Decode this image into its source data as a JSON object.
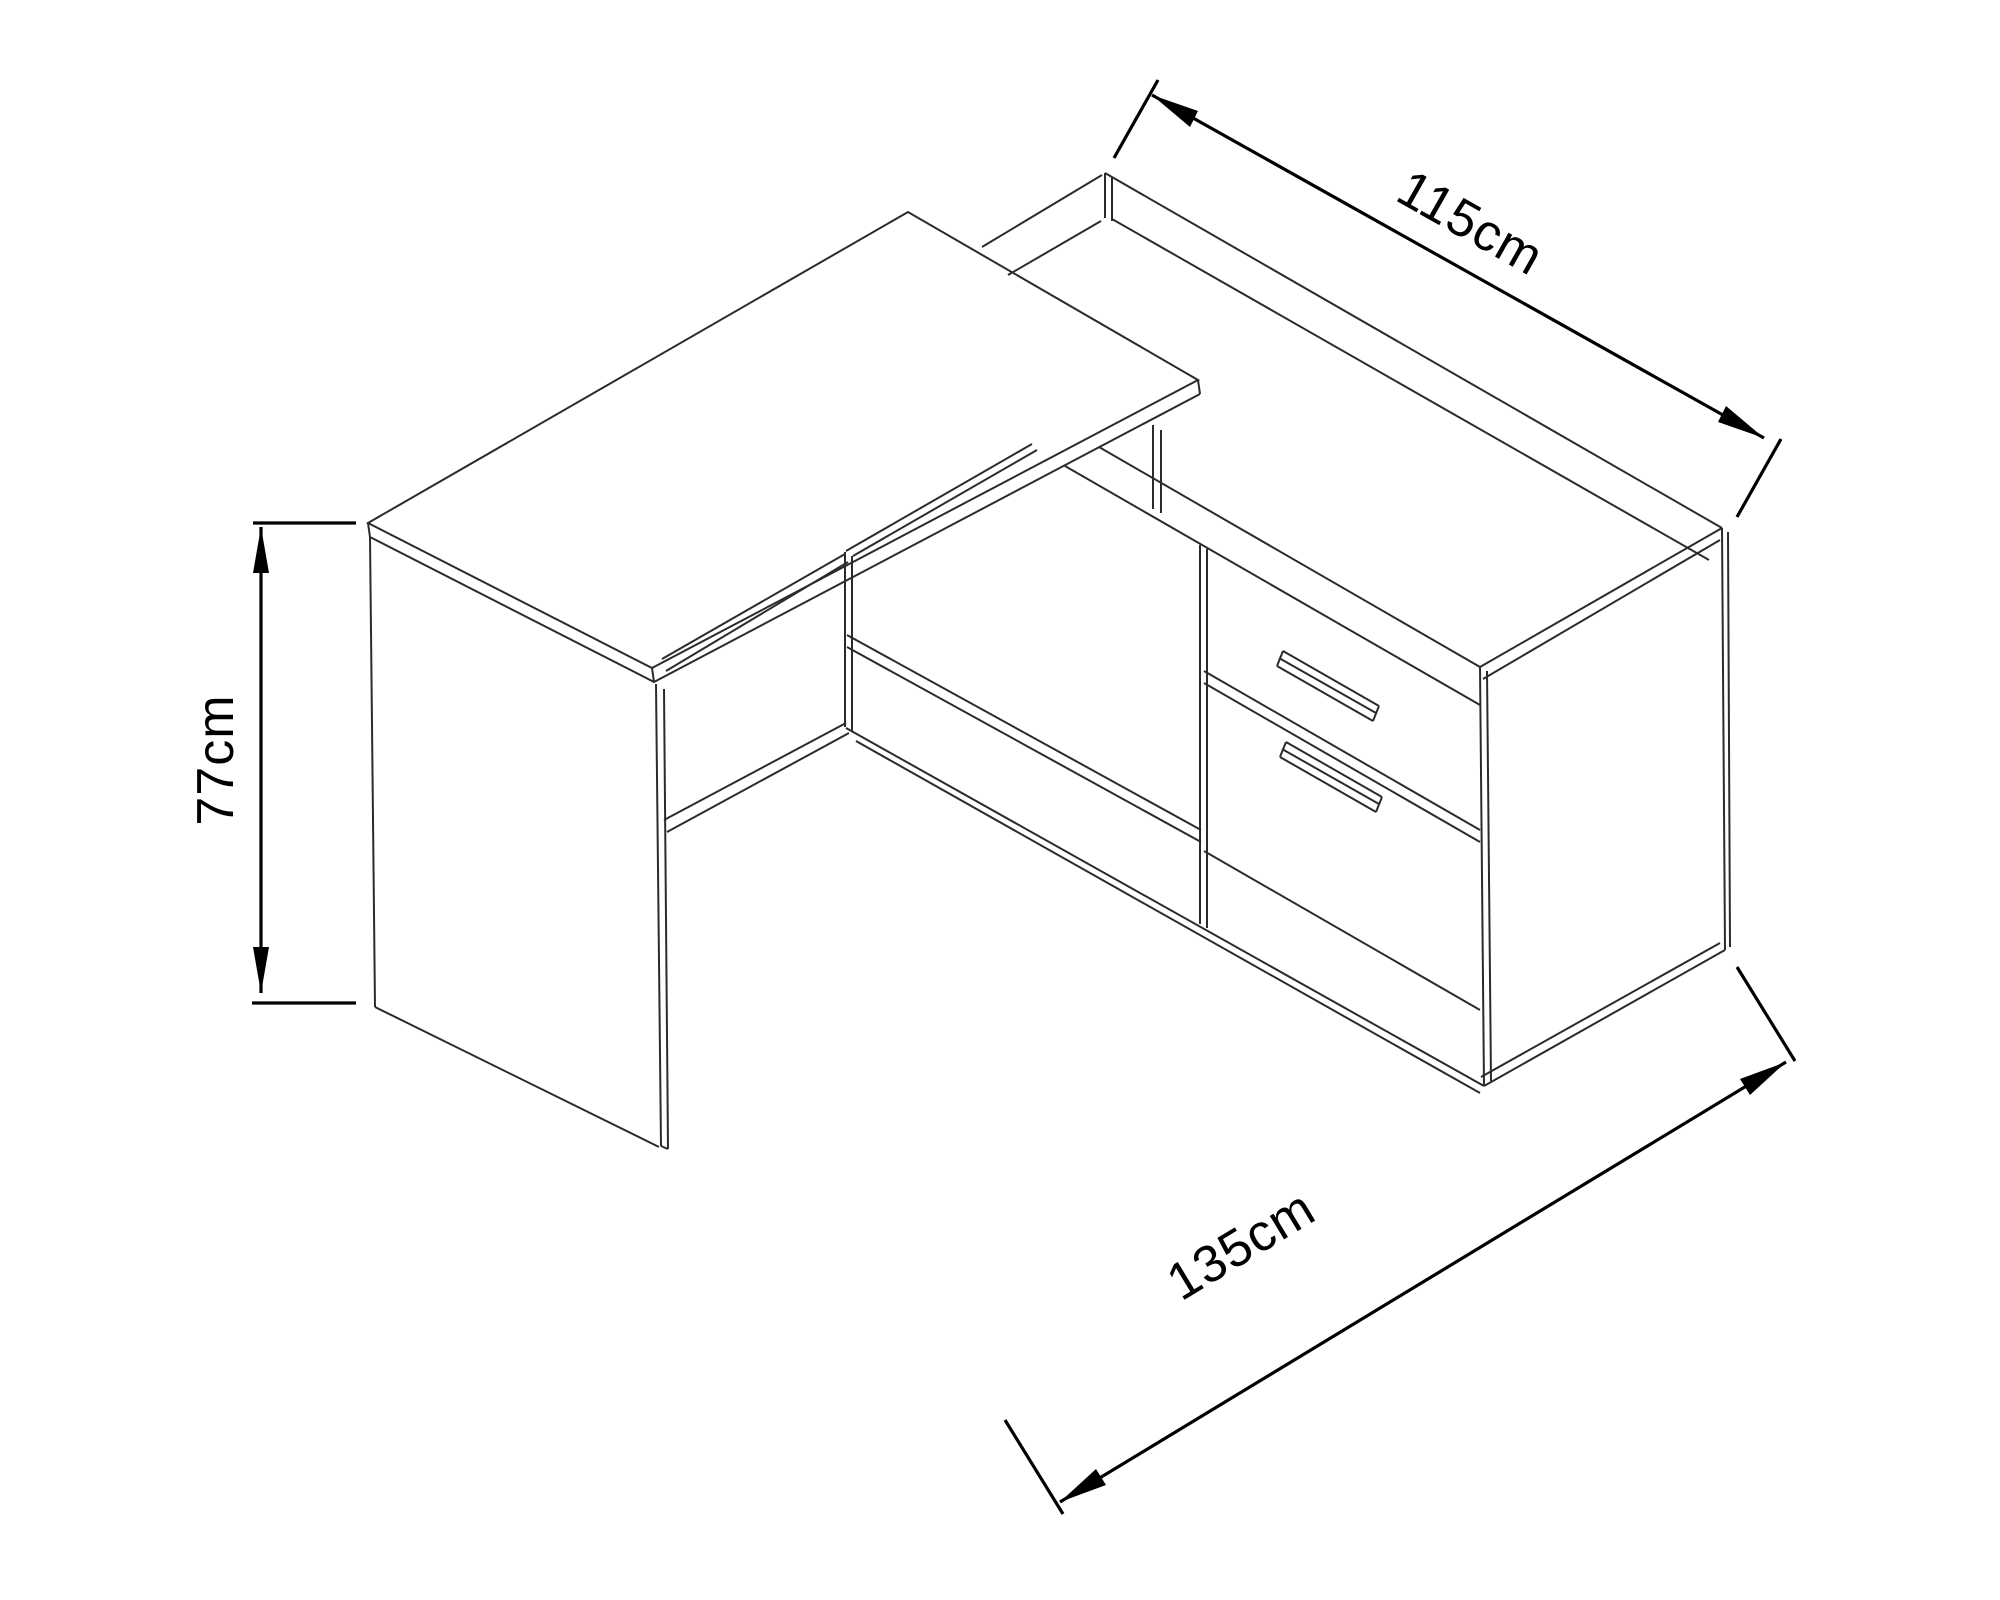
{
  "diagram": {
    "type": "isometric-technical-drawing",
    "subject": "l-shaped-corner-desk-with-cabinet",
    "colors": {
      "background": "#ffffff",
      "furniture_line": "#2b2b2b",
      "dimension_line": "#000000",
      "label_text": "#000000"
    }
  },
  "dimensions": {
    "top": {
      "label": "115cm",
      "measures": "cabinet-side-length"
    },
    "left": {
      "label": "77cm",
      "measures": "desk-height"
    },
    "bottom": {
      "label": "135cm",
      "measures": "desk-side-length"
    }
  }
}
